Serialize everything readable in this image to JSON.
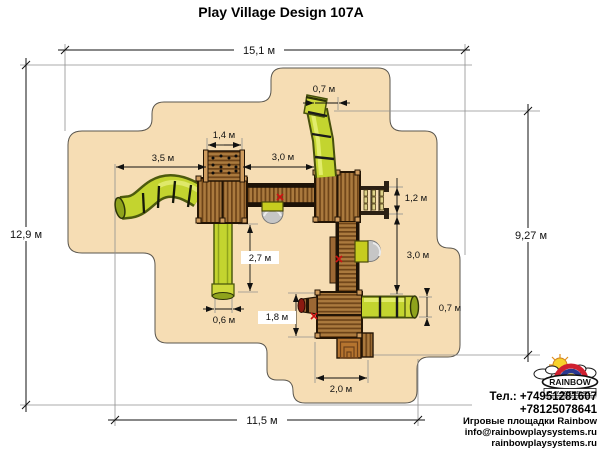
{
  "title": "Play Village Design 107A",
  "dimensions": {
    "overall_width_top": "15,1 м",
    "overall_height_left": "12,9 м",
    "overall_height_right": "9,27 м",
    "overall_width_bottom": "11,5 м",
    "wave_slide_length": "3,5 м",
    "climbing_wall_width": "1,4 м",
    "bridge_length": "3,0 м",
    "top_tube_width": "0,7 м",
    "net_height": "1,2 м",
    "right_walkway_length": "3,0 м",
    "straight_slide_length": "2,7 м",
    "straight_slide_width": "0,6 м",
    "lower_tower_height": "1,8 м",
    "stairs_width": "2,0 м",
    "right_tube_width": "0,7 м"
  },
  "logo": {
    "brand": "RAINBOW",
    "subtitle": "PLAY SYSTEMS, INC.",
    "tagline": "FOR RESIDENTIAL PLAY EQUIPMENT"
  },
  "contact": {
    "phone_line1": "Тел.: +74951281607",
    "phone_line2": "+78125078641",
    "company_line": "Игровые площадки Rainbow",
    "email": "info@rainbowplaysystems.ru",
    "website": "rainbowplaysystems.ru"
  },
  "colors": {
    "ground": "#f6ddb4",
    "wood": "#ab7a3e",
    "wood_dark": "#6e4418",
    "slide_yellow": "#c3d42f",
    "dim_line": "#111111"
  }
}
